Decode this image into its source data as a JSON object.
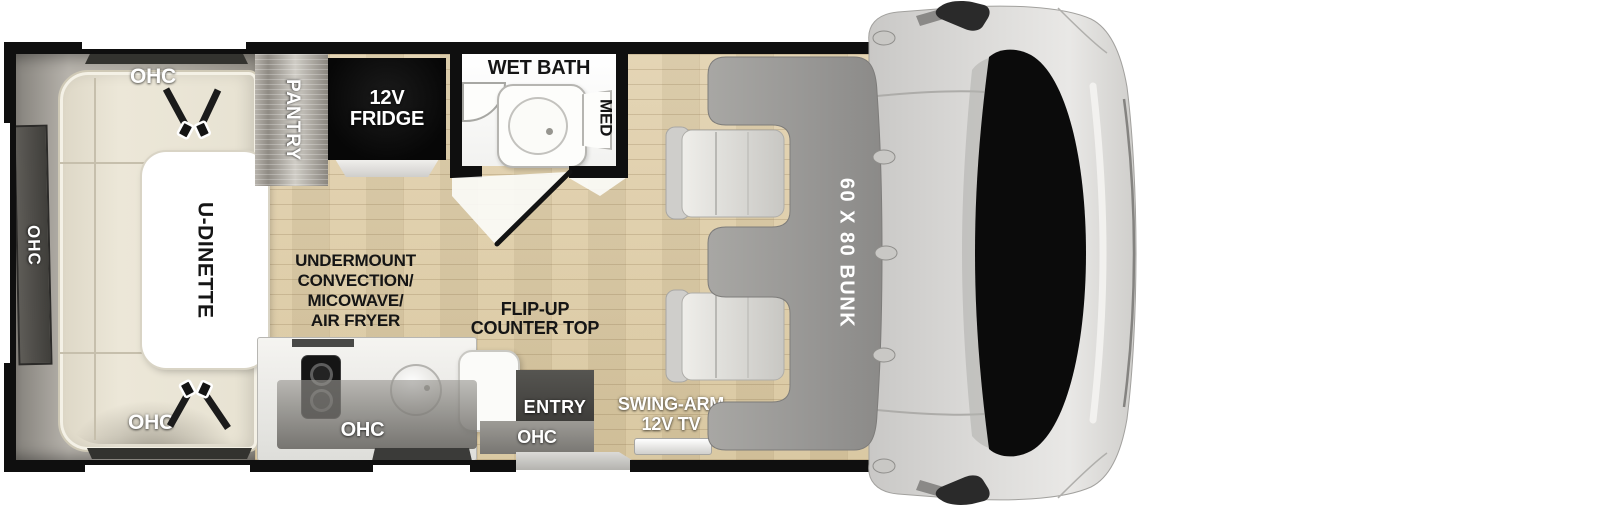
{
  "floorplan": {
    "labels": {
      "ohc": "OHC",
      "pantry": "PANTRY",
      "fridge": [
        "12V",
        "FRIDGE"
      ],
      "wet_bath": "WET BATH",
      "med": "MED",
      "u_dinette": "U-DINETTE",
      "undermount": [
        "UNDERMOUNT",
        "CONVECTION/",
        "MICOWAVE/",
        "AIR FRYER"
      ],
      "flip_up": [
        "FLIP-UP",
        "COUNTER TOP"
      ],
      "entry": "ENTRY",
      "swing_arm": [
        "SWING-ARM",
        "12V TV"
      ],
      "bunk": "60 X 80 BUNK"
    },
    "colors": {
      "wall": "#0f0f0f",
      "wood_floor": "#dccaa5",
      "cushion_cream": "#eae5d6",
      "cabinet_gray": "#a49f98",
      "bunk_gray": "#9a9997",
      "seat_gray": "#d9d8d4",
      "fridge_black": "#0c0c0c",
      "label_dark": "#151515",
      "label_light": "#ffffff"
    }
  }
}
